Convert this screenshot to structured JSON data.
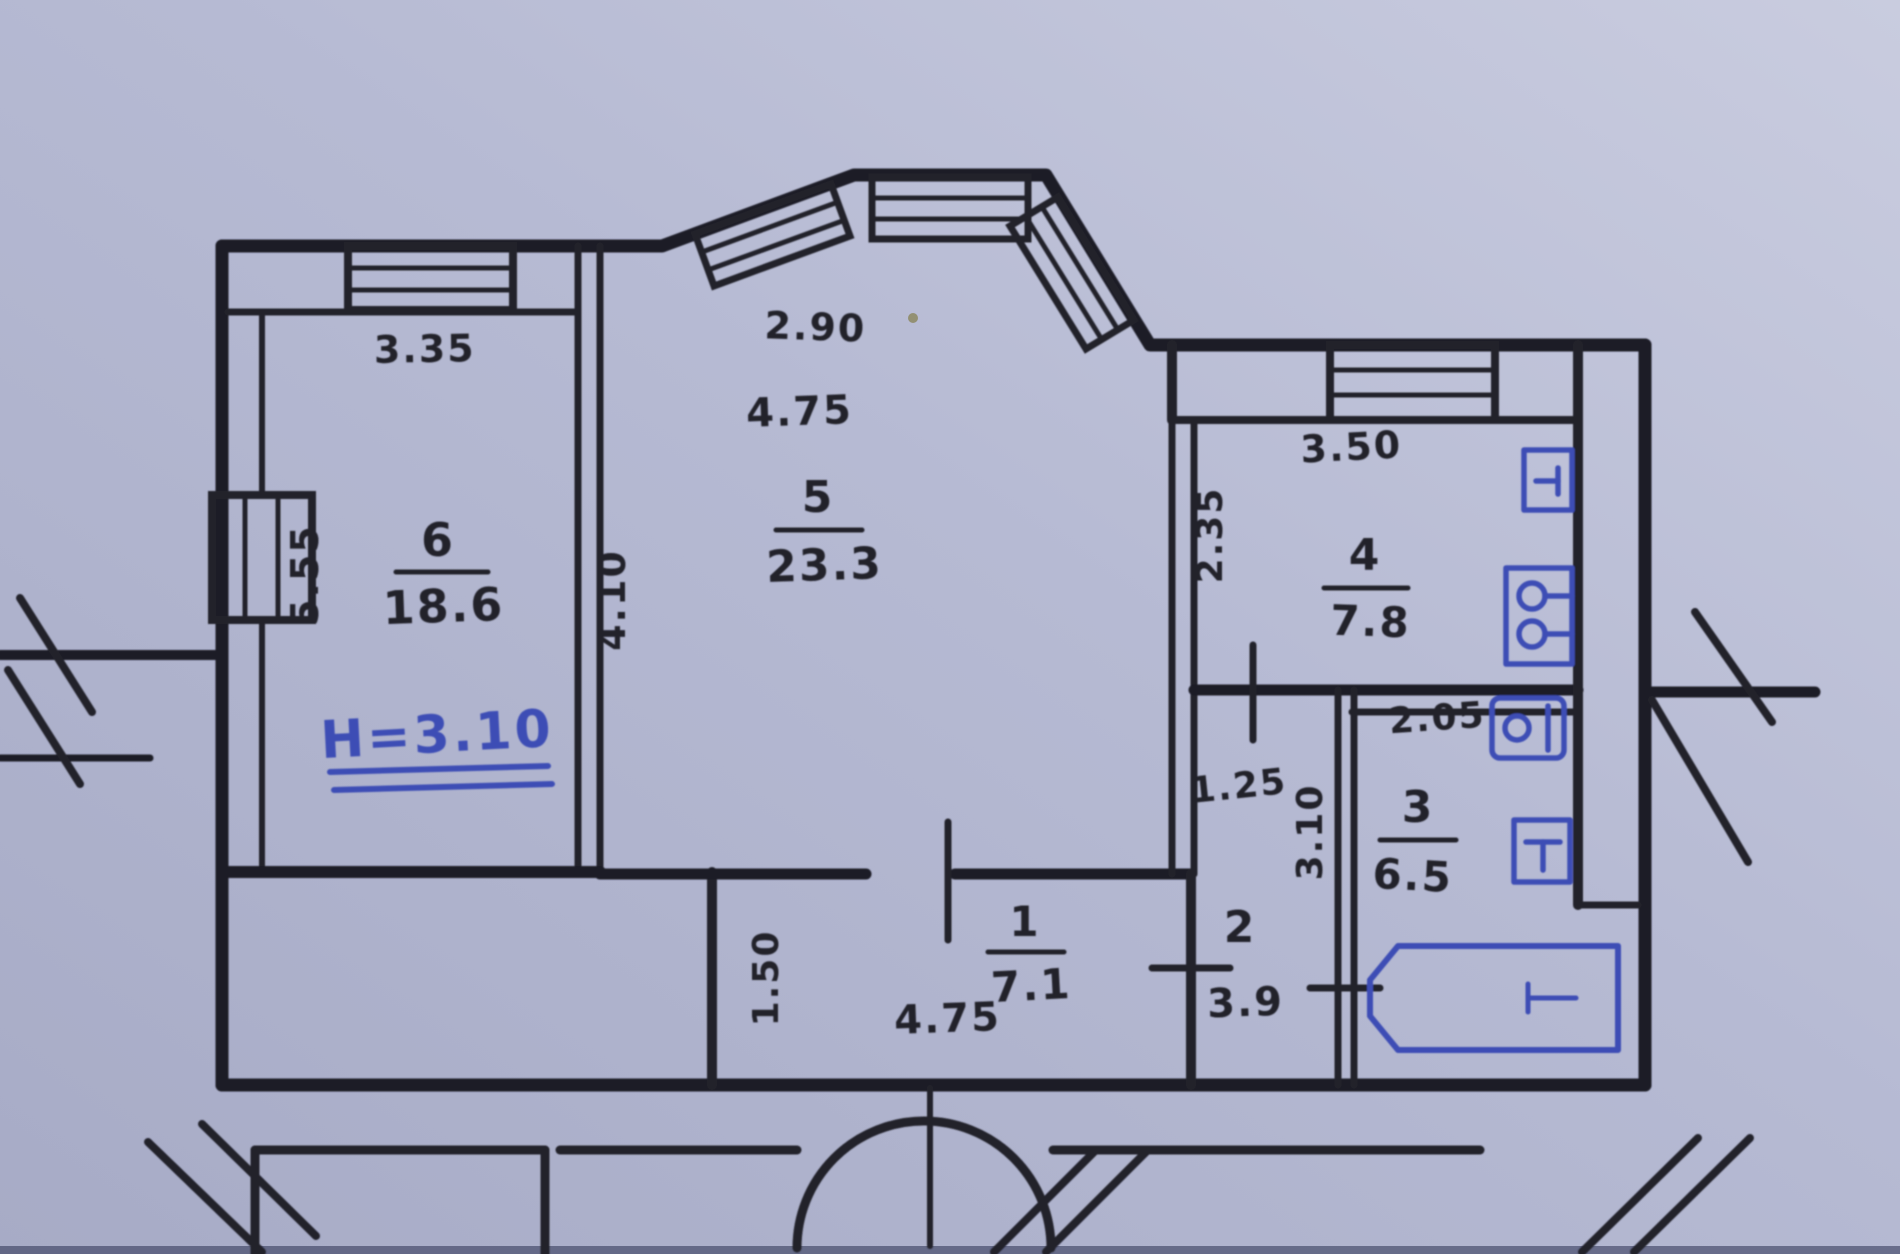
{
  "document": {
    "type": "hand-drawn apartment floor plan (scanned BTI sketch)",
    "colors": {
      "paper_light": "#c9ccdf",
      "paper_dark": "#a7abc6",
      "ink": "#23232c",
      "pen_blue": "#3d4eb5"
    }
  },
  "rooms": [
    {
      "number": "1",
      "area": "7.1"
    },
    {
      "number": "2",
      "area": "3.9"
    },
    {
      "number": "3",
      "area": "6.5"
    },
    {
      "number": "4",
      "area": "7.8"
    },
    {
      "number": "5",
      "area": "23.3"
    },
    {
      "number": "6",
      "area": "18.6"
    }
  ],
  "dimensions": {
    "room6_width": "3.35",
    "room6_depth": "5.55",
    "bay_width": "2.90",
    "room5_width": "4.75",
    "room5_depth": "4.10",
    "kitchen_width": "3.50",
    "kitchen_depth": "2.35",
    "bath_width": "2.05",
    "bath_depth": "3.10",
    "corridor_width": "1.25",
    "hall_width": "4.75",
    "hall_depth": "1.50"
  },
  "notes": {
    "ceiling_height": "H=3.10"
  }
}
